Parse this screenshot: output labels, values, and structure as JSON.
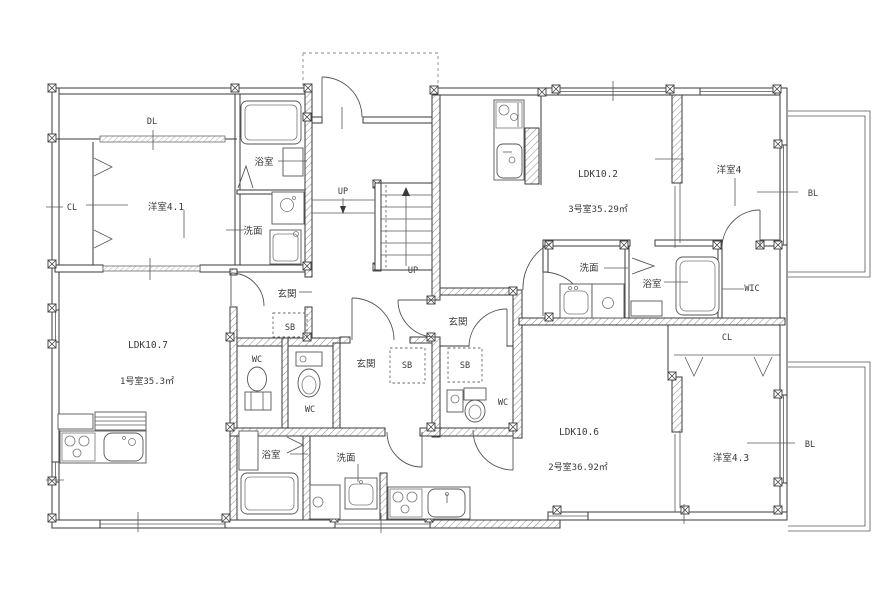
{
  "drawing": {
    "type": "apartment-floor-plan",
    "line_color": "#3a3a3a",
    "background_color": "#ffffff"
  },
  "stairs": {
    "up_label_1": "UP",
    "up_label_2": "UP"
  },
  "units": [
    {
      "id": "unit-1",
      "name_label": "1号室35.3㎡",
      "ldk_label": "LDK10.7",
      "rooms": {
        "yoshitsu": "洋室4.1",
        "cl": "CL",
        "dl": "DL",
        "bath": "浴室",
        "senmen": "洗面",
        "genkan": "玄関",
        "sb": "SB",
        "wc": "WC"
      }
    },
    {
      "id": "unit-2",
      "name_label": "2号室36.92㎡",
      "ldk_label": "LDK10.6",
      "rooms": {
        "yoshitsu": "洋室4.3",
        "cl": "CL",
        "bl": "BL",
        "bath": "浴室",
        "senmen": "洗面",
        "genkan": "玄関",
        "sb": "SB",
        "wc": "WC"
      }
    },
    {
      "id": "unit-3",
      "name_label": "3号室35.29㎡",
      "ldk_label": "LDK10.2",
      "rooms": {
        "yoshitsu": "洋室4",
        "wic": "WIC",
        "bl": "BL",
        "bath": "浴室",
        "senmen": "洗面",
        "genkan": "玄関",
        "sb": "SB",
        "wc": "WC"
      }
    }
  ]
}
